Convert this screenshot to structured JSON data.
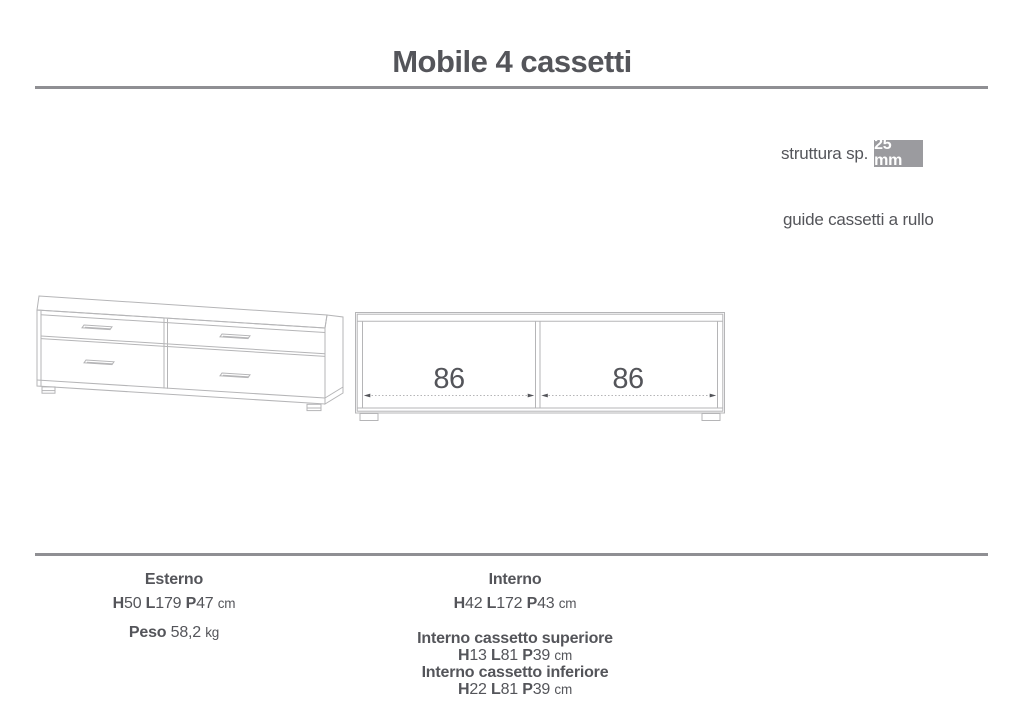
{
  "page": {
    "title": "Mobile 4 cassetti"
  },
  "annotations": {
    "struttura_label": "struttura sp.",
    "struttura_value": "25 mm",
    "guide_note": "guide cassetti a rullo"
  },
  "front_view": {
    "left_width_label": "86",
    "right_width_label": "86"
  },
  "specs": {
    "esterno": {
      "heading": "Esterno",
      "dims": [
        {
          "k": "H",
          "v": "50"
        },
        {
          "k": "L",
          "v": "179"
        },
        {
          "k": "P",
          "v": "47"
        }
      ],
      "unit": "cm",
      "peso": {
        "label": "Peso",
        "value": "58,2",
        "unit": "kg"
      }
    },
    "interno": {
      "heading": "Interno",
      "dims": [
        {
          "k": "H",
          "v": "42"
        },
        {
          "k": "L",
          "v": "172"
        },
        {
          "k": "P",
          "v": "43"
        }
      ],
      "unit": "cm"
    },
    "cassetto_superiore": {
      "heading": "Interno cassetto superiore",
      "dims": [
        {
          "k": "H",
          "v": "13"
        },
        {
          "k": "L",
          "v": "81"
        },
        {
          "k": "P",
          "v": "39"
        }
      ],
      "unit": "cm"
    },
    "cassetto_inferiore": {
      "heading": "Interno cassetto inferiore",
      "dims": [
        {
          "k": "H",
          "v": "22"
        },
        {
          "k": "L",
          "v": "81"
        },
        {
          "k": "P",
          "v": "39"
        }
      ],
      "unit": "cm"
    }
  },
  "colors": {
    "text": "#54555a",
    "line": "#8f8f93",
    "drawing": "#b5b5b7",
    "badge_bg": "#9b9b9f",
    "badge_text": "#ffffff"
  }
}
